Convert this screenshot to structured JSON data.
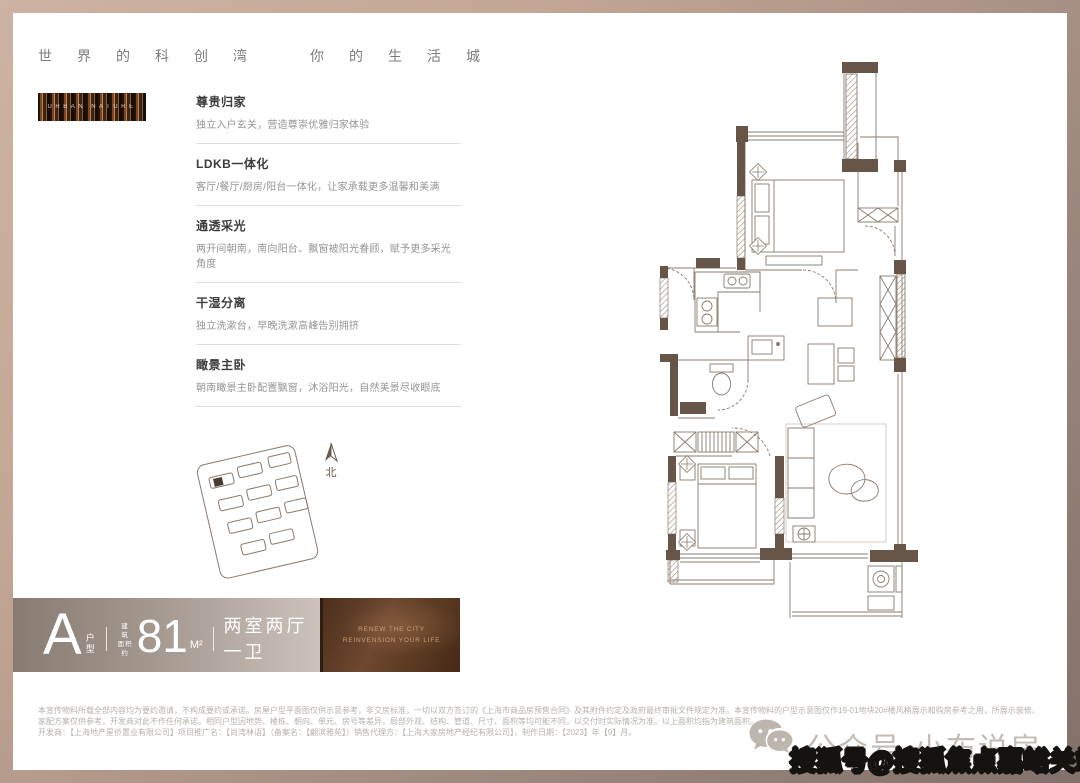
{
  "header": {
    "left": "世界的科创湾",
    "right": "你的生活城"
  },
  "brand": {
    "label": "URBAN NATURE"
  },
  "features": [
    {
      "title": "尊贵归家",
      "desc": "独立入户玄关，营造尊崇优雅归家体验"
    },
    {
      "title": "LDKB一体化",
      "desc": "客厅/餐厅/厨房/阳台一体化，让家承载更多温馨和美满"
    },
    {
      "title": "通透采光",
      "desc": "两开间朝南，南向阳台、飘窗被阳光眷顾，赋予更多采光角度"
    },
    {
      "title": "干湿分离",
      "desc": "独立洗漱台，早晚洗漱高峰告别拥挤"
    },
    {
      "title": "瞰景主卧",
      "desc": "朝南瞰景主卧配置飘窗，沐浴阳光，自然美景尽收眼底"
    }
  ],
  "siteplan": {
    "north": "北"
  },
  "typebar": {
    "letter": "A",
    "letter_suffix_top": "户",
    "letter_suffix_bottom": "型",
    "area_label_top": "建 筑",
    "area_label_bottom": "面积约",
    "area": "81",
    "unit": "M²",
    "rooms": "两室两厅一卫",
    "panel_line1": "RENEW THE CITY",
    "panel_line2": "REINVENSION YOUR LIFE"
  },
  "disclaimer": {
    "para1": "本宣传物料所载全部内容均为要约邀请，不构成要约或承诺。房屋户型平面图仅供示意参考，非交房标准，一切以双方签订的《上海市商品房预售合同》及其附件约定及政府最终审批文件规定为准。本宣传物料的户型示意图仅作19-01地块20#楼风格展示和购房参考之用，所展示装修、家配方案仅供参考，开发商对此不作任何承诺。相同户型因地势、楼栋、朝向、单元、房号等差异，局部外观、结构、管道、尺寸、面积等均可能不同，以交付时实际情况为准。以上面积均指为建筑面积。",
    "para2": "开发商：【上海地产星侨置业有限公司】项目推广名：【尚湾林语】（备案名：【翩滨雅苑】）销售代理方：【上海大家房地产经纪有限公司】，制作日期：【2023】年【9】月。"
  },
  "watermark": {
    "wechat_text": "公众号·小布说房",
    "sohu_text": "搜狐号@搜狐焦点嘉峪关站"
  },
  "colors": {
    "frame_light": "#cdb3a3",
    "frame_dark": "#82716a",
    "plan_wall": "#675648",
    "plan_line": "#8a7a6c",
    "bar_gradient_left": "#877b72",
    "bar_gradient_right": "#cbc2ba",
    "panel_brown": "#5b3a22",
    "panel_text": "#c99c79"
  }
}
